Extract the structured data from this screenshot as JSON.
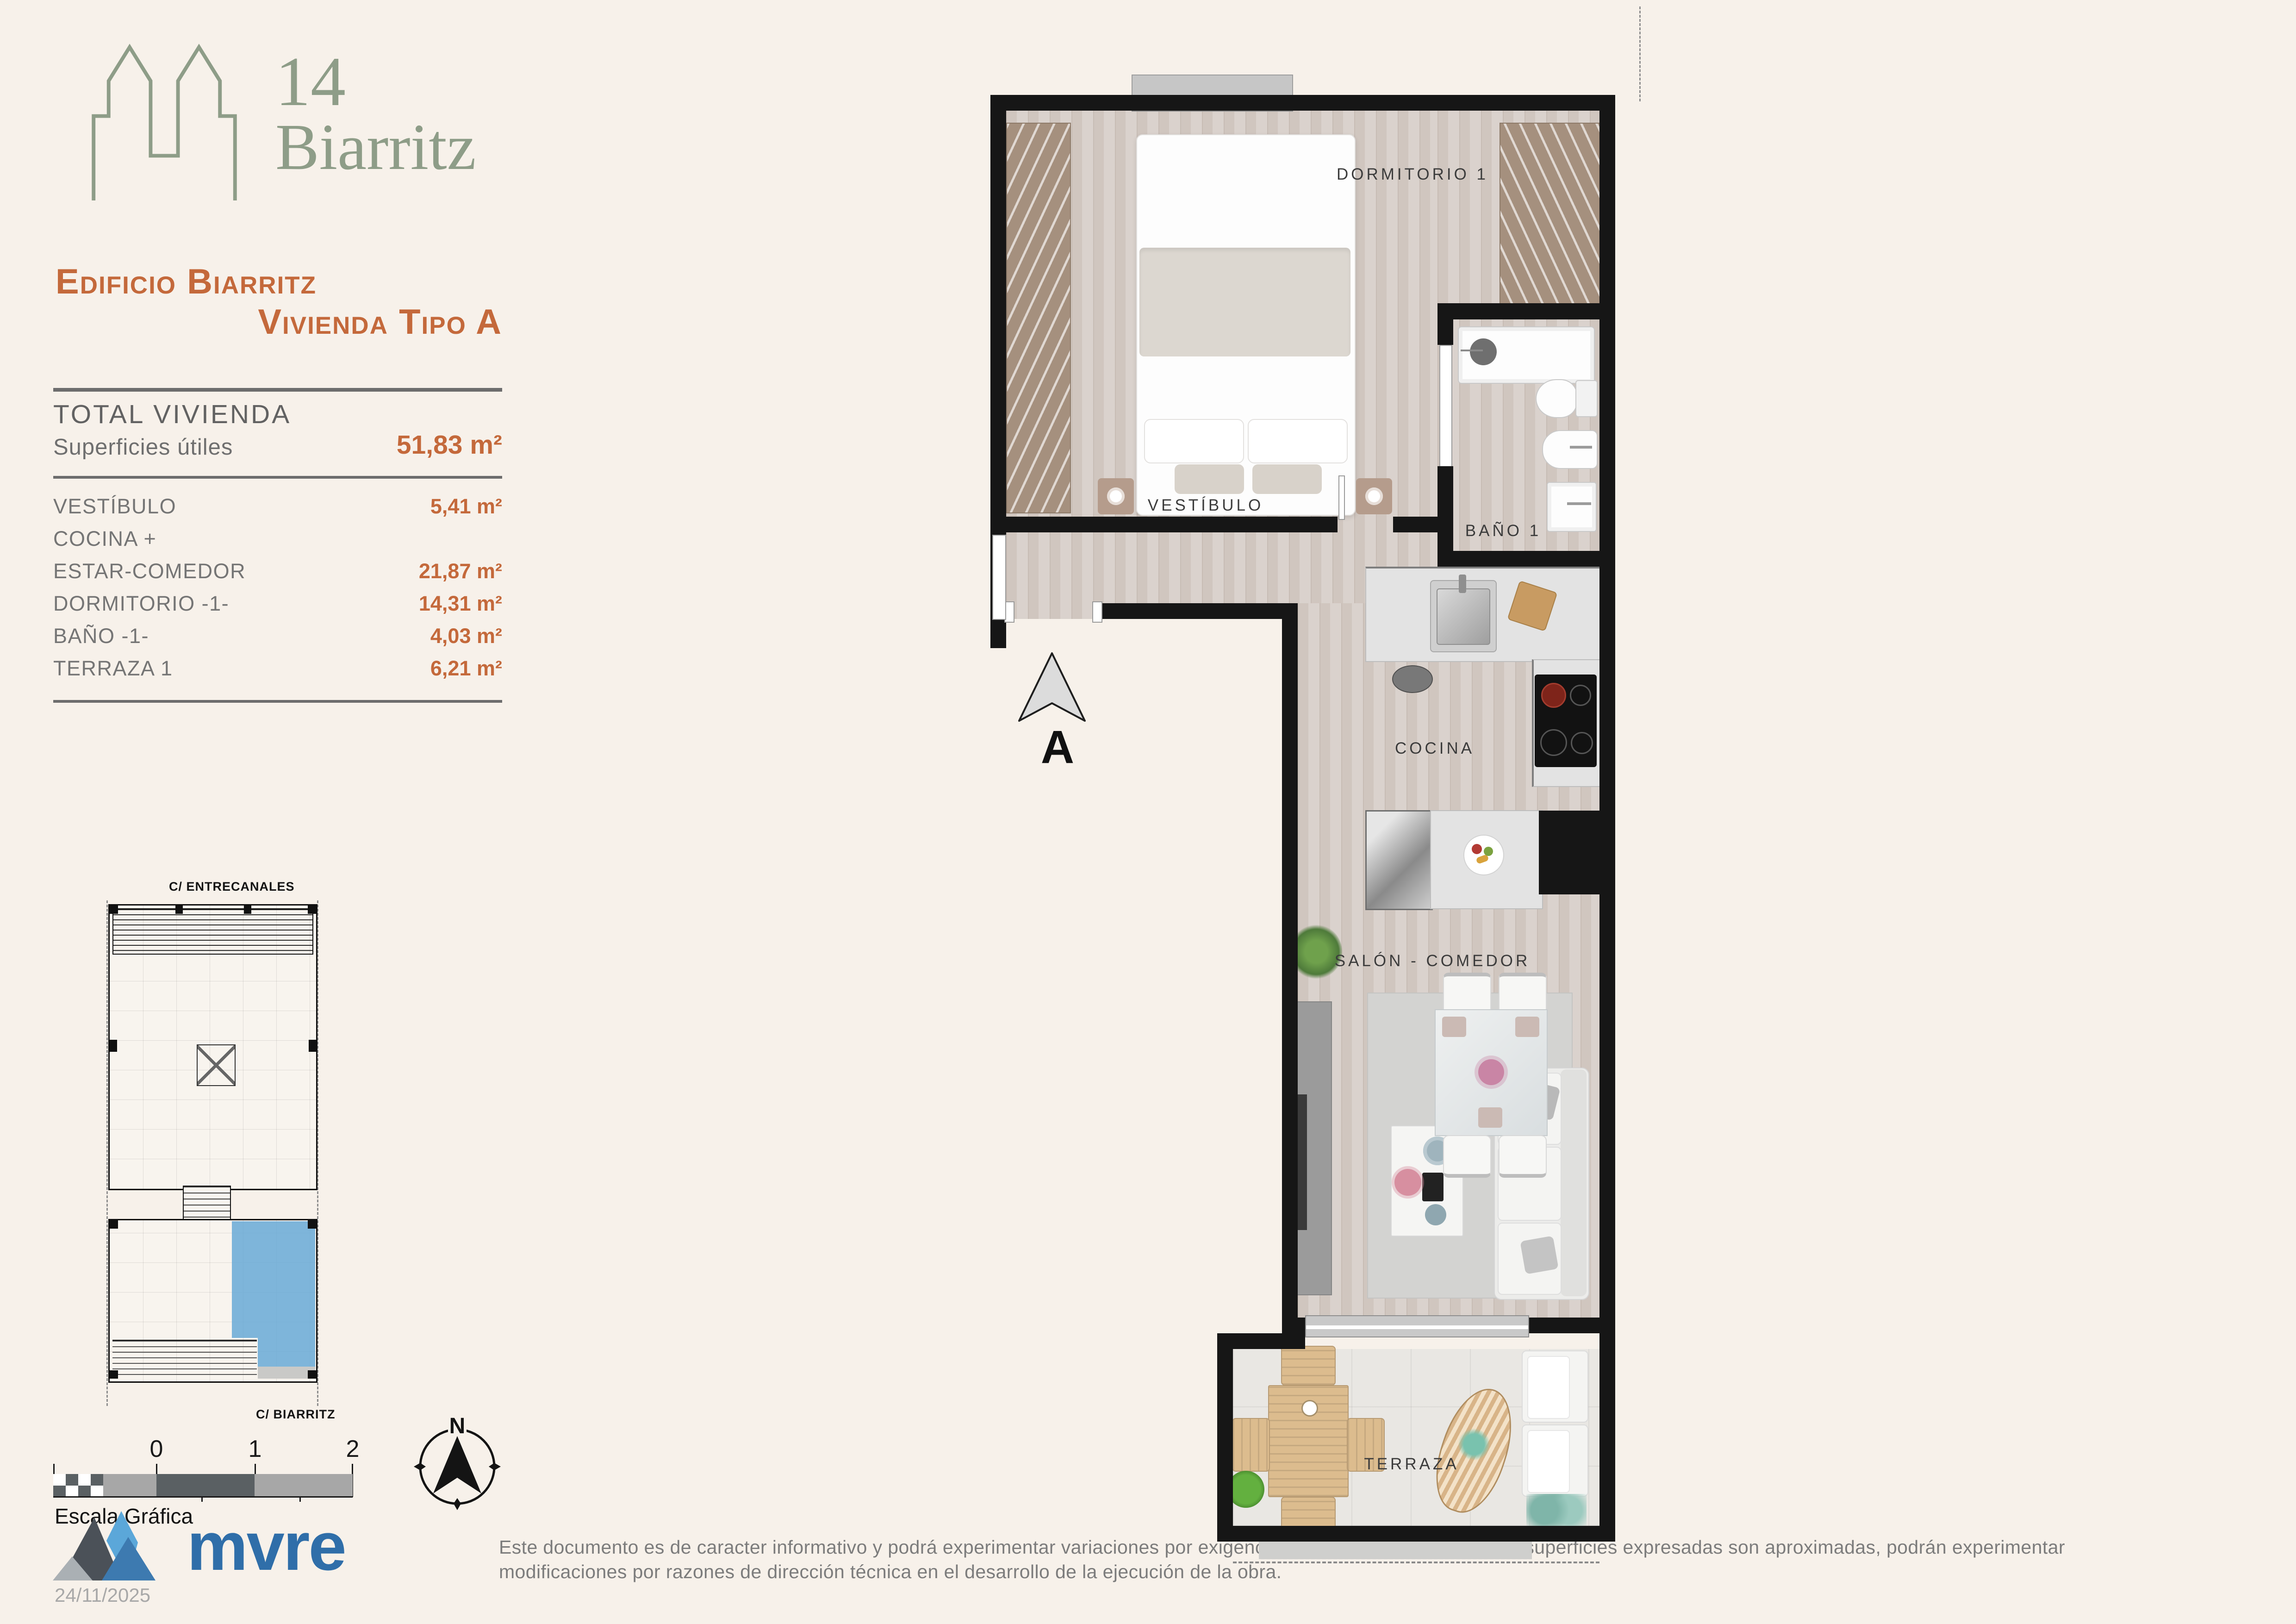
{
  "brand": {
    "number": "14",
    "name": "Biarritz"
  },
  "title": {
    "line1": "Edificio Biarritz",
    "line2": "Vivienda Tipo A"
  },
  "summary": {
    "total_label": "TOTAL VIVIENDA",
    "subtotal_label": "Superficies útiles",
    "total_value": "51,83 m²",
    "rows": [
      {
        "label": "VESTÍBULO",
        "value": "5,41 m²"
      },
      {
        "label": "COCINA +",
        "value": ""
      },
      {
        "label": "ESTAR-COMEDOR",
        "value": "21,87 m²"
      },
      {
        "label": "DORMITORIO -1-",
        "value": "14,31 m²"
      },
      {
        "label": "BAÑO -1-",
        "value": "4,03 m²"
      },
      {
        "label": "TERRAZA 1",
        "value": "6,21 m²"
      }
    ]
  },
  "floor_plan": {
    "rooms": {
      "dormitorio": "DORMITORIO 1",
      "bano": "BAÑO 1",
      "vestibulo": "VESTÍBULO",
      "cocina": "COCINA",
      "salon": "SALÓN - COMEDOR",
      "terraza": "TERRAZA"
    },
    "section_marker": "A"
  },
  "site_plan": {
    "street_top": "C/ ENTRECANALES",
    "street_bottom": "C/ BIARRITZ"
  },
  "scale_bar": {
    "labels": [
      "0",
      "1",
      "2"
    ],
    "caption": "Escala Gráfica"
  },
  "compass": {
    "north_label": "N"
  },
  "footer": {
    "logo_text": "mvre",
    "date": "24/11/2025",
    "disclaimer": "Este documento es de caracter informativo y podrá experimentar variaciones por exigencias técnicas del proyecto. Las superficies expresadas son aproximadas, podrán experimentar modificaciones por razones de dirección técnica en el desarrollo de la ejecución de la obra."
  },
  "colors": {
    "accent_orange": "#c4693b",
    "brand_green": "#8e9d88",
    "highlight_blue": "#68a9d6",
    "mvre_blue": "#2f6ea9",
    "background": "#f7f1ea"
  }
}
